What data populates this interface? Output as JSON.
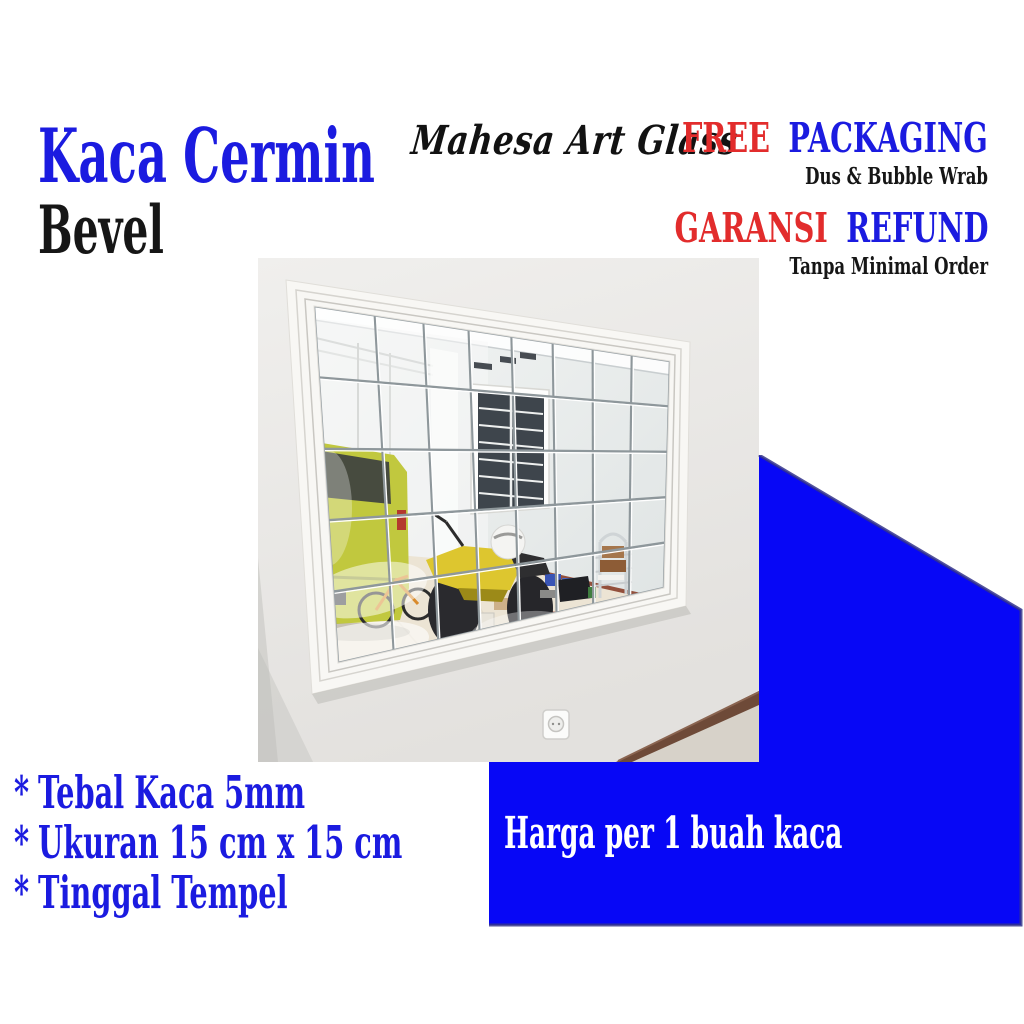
{
  "title": {
    "line1": "Kaca Cermin",
    "line2": "Bevel"
  },
  "brand": "Mahesa Art Glass",
  "offers": {
    "free": "FREE",
    "packaging": "PACKAGING",
    "packaging_sub": "Dus & Bubble Wrab",
    "garansi": "GARANSI",
    "refund": "REFUND",
    "refund_sub": "Tanpa Minimal Order"
  },
  "features": [
    {
      "bullet": "*",
      "label": "Tebal Kaca 5mm"
    },
    {
      "bullet": "*",
      "label": "Ukuran 15 cm x 15 cm"
    },
    {
      "bullet": "*",
      "label": "Tinggal Tempel"
    }
  ],
  "price_banner": {
    "label": "Harga per 1 buah kaca"
  },
  "photo": {
    "description": "Beveled mirror tile grid (8 x 5 tiles) in a white molded frame on a wall, reflecting a garage with a yellow-green car, yellow motorcycle with white helmet, window with white grill, chrome rack and boxes on a cream floor"
  },
  "colors": {
    "accent_blue": "#0707f6",
    "text_blue": "#1b1be0",
    "red": "#e22c2c",
    "navy_edge": "#34348c",
    "black": "#161616",
    "banner_text": "#ffffff"
  }
}
